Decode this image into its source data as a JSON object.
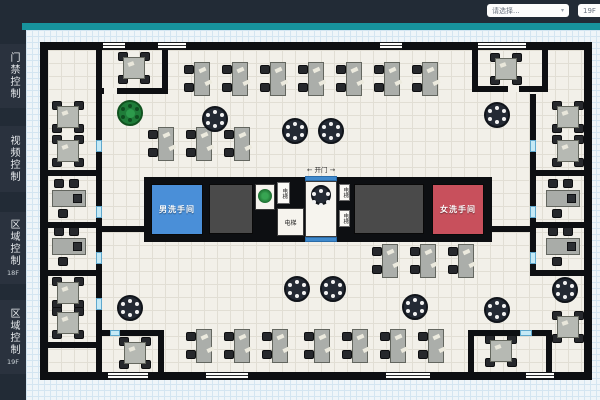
{
  "topbar": {
    "select_building": "请选择...",
    "select_floor": "19F",
    "caret": "▾"
  },
  "sidebar": {
    "items": [
      {
        "label": "门禁控制",
        "sub": ""
      },
      {
        "label": "视频控制",
        "sub": ""
      },
      {
        "label": "区域控制",
        "sub": "18F"
      },
      {
        "label": "区域控制",
        "sub": "19F"
      }
    ]
  },
  "plan": {
    "labels": {
      "men_restroom": "男洗手间",
      "women_restroom": "女洗手间",
      "elevator": "电梯",
      "door": "← 开门 →"
    },
    "colors": {
      "men": "#4a8fd8",
      "women": "#c8505c",
      "gray": "#4a4a4a",
      "wall": "#0d0f12",
      "accent": "#17939d",
      "door_bar": "#3f89cc"
    },
    "elements": [
      {
        "t": "wall",
        "x": 40,
        "y": 42,
        "w": 552,
        "h": 8,
        "name": "outer-wall-top"
      },
      {
        "t": "wall",
        "x": 40,
        "y": 372,
        "w": 552,
        "h": 8,
        "name": "outer-wall-bottom"
      },
      {
        "t": "wall",
        "x": 40,
        "y": 42,
        "w": 8,
        "h": 338,
        "name": "outer-wall-left"
      },
      {
        "t": "wall",
        "x": 584,
        "y": 42,
        "w": 8,
        "h": 338,
        "name": "outer-wall-right"
      },
      {
        "t": "winh",
        "x": 103,
        "y": 42,
        "w": 22,
        "h": 8,
        "name": "window"
      },
      {
        "t": "winh",
        "x": 158,
        "y": 42,
        "w": 28,
        "h": 8,
        "name": "window"
      },
      {
        "t": "winh",
        "x": 380,
        "y": 42,
        "w": 22,
        "h": 8,
        "name": "window"
      },
      {
        "t": "winh",
        "x": 478,
        "y": 42,
        "w": 48,
        "h": 8,
        "name": "window"
      },
      {
        "t": "winh",
        "x": 108,
        "y": 372,
        "w": 40,
        "h": 8,
        "name": "window"
      },
      {
        "t": "winh",
        "x": 206,
        "y": 372,
        "w": 42,
        "h": 8,
        "name": "window"
      },
      {
        "t": "winh",
        "x": 386,
        "y": 372,
        "w": 44,
        "h": 8,
        "name": "window"
      },
      {
        "t": "winh",
        "x": 526,
        "y": 372,
        "w": 28,
        "h": 8,
        "name": "window"
      },
      {
        "t": "wall",
        "x": 96,
        "y": 50,
        "w": 6,
        "h": 38,
        "name": "meeting-room-wall"
      },
      {
        "t": "wall",
        "x": 96,
        "y": 88,
        "w": 72,
        "h": 6,
        "name": "meeting-room-wall"
      },
      {
        "t": "whitegap",
        "x": 104,
        "y": 88,
        "w": 13,
        "h": 6,
        "name": "door-gap",
        "i": true
      },
      {
        "t": "wall",
        "x": 162,
        "y": 50,
        "w": 6,
        "h": 44,
        "name": "meeting-room-wall"
      },
      {
        "t": "wall",
        "x": 472,
        "y": 50,
        "w": 6,
        "h": 42,
        "name": "meeting-room-wall"
      },
      {
        "t": "wall",
        "x": 472,
        "y": 86,
        "w": 76,
        "h": 6,
        "name": "meeting-room-wall"
      },
      {
        "t": "whitegap",
        "x": 508,
        "y": 86,
        "w": 11,
        "h": 6,
        "name": "door-gap",
        "i": true
      },
      {
        "t": "wall",
        "x": 542,
        "y": 50,
        "w": 6,
        "h": 36,
        "name": "meeting-room-wall"
      },
      {
        "t": "wall",
        "x": 96,
        "y": 94,
        "w": 6,
        "h": 278,
        "name": "left-corridor-wall"
      },
      {
        "t": "wall",
        "x": 530,
        "y": 94,
        "w": 6,
        "h": 182,
        "name": "right-corridor-wall"
      },
      {
        "t": "wall",
        "x": 48,
        "y": 170,
        "w": 50,
        "h": 6,
        "name": "room-divider"
      },
      {
        "t": "wall",
        "x": 48,
        "y": 222,
        "w": 50,
        "h": 6,
        "name": "room-divider"
      },
      {
        "t": "wall",
        "x": 48,
        "y": 270,
        "w": 50,
        "h": 6,
        "name": "room-divider"
      },
      {
        "t": "wall",
        "x": 48,
        "y": 342,
        "w": 50,
        "h": 6,
        "name": "room-divider"
      },
      {
        "t": "wall",
        "x": 536,
        "y": 170,
        "w": 48,
        "h": 6,
        "name": "room-divider"
      },
      {
        "t": "wall",
        "x": 536,
        "y": 222,
        "w": 48,
        "h": 6,
        "name": "room-divider"
      },
      {
        "t": "wall",
        "x": 530,
        "y": 270,
        "w": 62,
        "h": 6,
        "name": "room-divider"
      },
      {
        "t": "wall",
        "x": 102,
        "y": 226,
        "w": 42,
        "h": 6,
        "name": "core-stub-wall"
      },
      {
        "t": "wall",
        "x": 492,
        "y": 226,
        "w": 38,
        "h": 6,
        "name": "core-stub-wall"
      },
      {
        "t": "wall",
        "x": 98,
        "y": 330,
        "w": 66,
        "h": 6,
        "name": "bottom-room-wall"
      },
      {
        "t": "gaph",
        "x": 110,
        "y": 330,
        "w": 10,
        "h": 6,
        "name": "door-gap",
        "i": true
      },
      {
        "t": "wall",
        "x": 158,
        "y": 330,
        "w": 6,
        "h": 42,
        "name": "bottom-room-wall"
      },
      {
        "t": "wall",
        "x": 468,
        "y": 330,
        "w": 84,
        "h": 6,
        "name": "bottom-room-wall"
      },
      {
        "t": "gaph",
        "x": 520,
        "y": 330,
        "w": 12,
        "h": 6,
        "name": "door-gap",
        "i": true
      },
      {
        "t": "wall",
        "x": 468,
        "y": 330,
        "w": 6,
        "h": 42,
        "name": "bottom-room-wall"
      },
      {
        "t": "wall",
        "x": 546,
        "y": 330,
        "w": 6,
        "h": 42,
        "name": "bottom-room-wall"
      },
      {
        "t": "gapv",
        "x": 96,
        "y": 140,
        "w": 6,
        "h": 12,
        "name": "door-gap",
        "i": true
      },
      {
        "t": "gapv",
        "x": 96,
        "y": 206,
        "w": 6,
        "h": 12,
        "name": "door-gap",
        "i": true
      },
      {
        "t": "gapv",
        "x": 96,
        "y": 252,
        "w": 6,
        "h": 12,
        "name": "door-gap",
        "i": true
      },
      {
        "t": "gapv",
        "x": 96,
        "y": 298,
        "w": 6,
        "h": 12,
        "name": "door-gap",
        "i": true
      },
      {
        "t": "gapv",
        "x": 530,
        "y": 140,
        "w": 6,
        "h": 12,
        "name": "door-gap",
        "i": true
      },
      {
        "t": "gapv",
        "x": 530,
        "y": 206,
        "w": 6,
        "h": 12,
        "name": "door-gap",
        "i": true
      },
      {
        "t": "gapv",
        "x": 530,
        "y": 252,
        "w": 6,
        "h": 12,
        "name": "door-gap",
        "i": true
      },
      {
        "t": "core",
        "x": 144,
        "y": 177,
        "w": 348,
        "h": 65,
        "name": "core-block"
      },
      {
        "t": "room",
        "c": "men",
        "x": 151,
        "y": 184,
        "w": 52,
        "h": 51,
        "label": "男洗手间",
        "name": "men-restroom",
        "i": true
      },
      {
        "t": "room",
        "c": "gray",
        "x": 209,
        "y": 184,
        "w": 44,
        "h": 50,
        "name": "stairs-block-a"
      },
      {
        "t": "cell",
        "x": 255,
        "y": 184,
        "w": 20,
        "h": 26,
        "name": "plant-cell"
      },
      {
        "t": "plant",
        "x": 258,
        "y": 189,
        "w": 14,
        "h": 14,
        "name": "plant-icon"
      },
      {
        "t": "vtag",
        "x": 277,
        "y": 182,
        "w": 13,
        "h": 22,
        "label": "电梯",
        "name": "elevator-tag",
        "i": true
      },
      {
        "t": "cell",
        "x": 277,
        "y": 208,
        "w": 27,
        "h": 28,
        "label": "电梯",
        "name": "elevator-cell",
        "i": true
      },
      {
        "t": "cell",
        "x": 305,
        "y": 181,
        "w": 32,
        "h": 56,
        "name": "lobby"
      },
      {
        "t": "bar",
        "x": 305,
        "y": 176,
        "w": 32,
        "h": 5,
        "name": "door-marker-top",
        "i": true
      },
      {
        "t": "bar",
        "x": 305,
        "y": 237,
        "w": 32,
        "h": 5,
        "name": "door-marker-bottom",
        "i": true
      },
      {
        "t": "round",
        "x": 311,
        "y": 185,
        "w": 20,
        "h": 20,
        "name": "lobby-round-table"
      },
      {
        "t": "vtag",
        "x": 339,
        "y": 184,
        "w": 11,
        "h": 17,
        "label": "电梯",
        "name": "elevator-tag",
        "i": true
      },
      {
        "t": "vtag",
        "x": 339,
        "y": 210,
        "w": 11,
        "h": 17,
        "label": "电梯",
        "name": "elevator-tag",
        "i": true
      },
      {
        "t": "room",
        "c": "gray",
        "x": 354,
        "y": 184,
        "w": 70,
        "h": 50,
        "name": "stairs-block-b"
      },
      {
        "t": "room",
        "c": "women",
        "x": 432,
        "y": 184,
        "w": 52,
        "h": 51,
        "label": "女洗手间",
        "name": "women-restroom",
        "i": true
      },
      {
        "t": "text",
        "x": 294,
        "y": 164,
        "w": 54,
        "h": 10,
        "label": "← 开门 →",
        "name": "door-label"
      },
      {
        "t": "table4",
        "x": 117,
        "y": 51,
        "name": "meeting-table"
      },
      {
        "t": "table4",
        "x": 489,
        "y": 52,
        "name": "meeting-table"
      },
      {
        "t": "table4",
        "x": 118,
        "y": 336,
        "name": "meeting-table"
      },
      {
        "t": "table4",
        "x": 484,
        "y": 334,
        "name": "meeting-table"
      },
      {
        "t": "table4",
        "x": 51,
        "y": 100,
        "name": "meeting-table"
      },
      {
        "t": "table4",
        "x": 51,
        "y": 134,
        "name": "meeting-table"
      },
      {
        "t": "table4",
        "x": 51,
        "y": 276,
        "name": "meeting-table"
      },
      {
        "t": "table4",
        "x": 51,
        "y": 306,
        "name": "meeting-table"
      },
      {
        "t": "table4",
        "x": 551,
        "y": 100,
        "name": "meeting-table"
      },
      {
        "t": "table4",
        "x": 551,
        "y": 134,
        "name": "meeting-table"
      },
      {
        "t": "table4",
        "x": 551,
        "y": 310,
        "name": "meeting-table"
      },
      {
        "t": "office",
        "x": 50,
        "y": 178,
        "name": "workstation"
      },
      {
        "t": "office",
        "x": 50,
        "y": 226,
        "name": "workstation"
      },
      {
        "t": "office",
        "x": 544,
        "y": 178,
        "name": "workstation"
      },
      {
        "t": "office",
        "x": 544,
        "y": 226,
        "name": "workstation"
      },
      {
        "t": "deskv",
        "x": 184,
        "y": 62,
        "name": "desk"
      },
      {
        "t": "deskv",
        "x": 222,
        "y": 62,
        "name": "desk"
      },
      {
        "t": "deskv",
        "x": 260,
        "y": 62,
        "name": "desk"
      },
      {
        "t": "deskv",
        "x": 298,
        "y": 62,
        "name": "desk"
      },
      {
        "t": "deskv",
        "x": 336,
        "y": 62,
        "name": "desk"
      },
      {
        "t": "deskv",
        "x": 374,
        "y": 62,
        "name": "desk"
      },
      {
        "t": "deskv",
        "x": 412,
        "y": 62,
        "name": "desk"
      },
      {
        "t": "deskv",
        "x": 148,
        "y": 127,
        "name": "desk"
      },
      {
        "t": "deskv",
        "x": 186,
        "y": 127,
        "name": "desk"
      },
      {
        "t": "deskv",
        "x": 224,
        "y": 127,
        "name": "desk"
      },
      {
        "t": "deskv",
        "x": 372,
        "y": 244,
        "name": "desk"
      },
      {
        "t": "deskv",
        "x": 410,
        "y": 244,
        "name": "desk"
      },
      {
        "t": "deskv",
        "x": 448,
        "y": 244,
        "name": "desk"
      },
      {
        "t": "deskv",
        "x": 186,
        "y": 329,
        "name": "desk"
      },
      {
        "t": "deskv",
        "x": 224,
        "y": 329,
        "name": "desk"
      },
      {
        "t": "deskv",
        "x": 262,
        "y": 329,
        "name": "desk"
      },
      {
        "t": "deskv",
        "x": 304,
        "y": 329,
        "name": "desk"
      },
      {
        "t": "deskv",
        "x": 342,
        "y": 329,
        "name": "desk"
      },
      {
        "t": "deskv",
        "x": 380,
        "y": 329,
        "name": "desk"
      },
      {
        "t": "deskv",
        "x": 418,
        "y": 329,
        "name": "desk"
      },
      {
        "t": "ground",
        "x": 117,
        "y": 100,
        "w": 26,
        "h": 26,
        "name": "green-round-table"
      },
      {
        "t": "round",
        "x": 202,
        "y": 106,
        "w": 26,
        "h": 26,
        "name": "round-table"
      },
      {
        "t": "round",
        "x": 282,
        "y": 118,
        "w": 26,
        "h": 26,
        "name": "round-table"
      },
      {
        "t": "round",
        "x": 318,
        "y": 118,
        "w": 26,
        "h": 26,
        "name": "round-table"
      },
      {
        "t": "round",
        "x": 484,
        "y": 102,
        "w": 26,
        "h": 26,
        "name": "round-table"
      },
      {
        "t": "round",
        "x": 117,
        "y": 295,
        "w": 26,
        "h": 26,
        "name": "round-table"
      },
      {
        "t": "round",
        "x": 284,
        "y": 276,
        "w": 26,
        "h": 26,
        "name": "round-table"
      },
      {
        "t": "round",
        "x": 320,
        "y": 276,
        "w": 26,
        "h": 26,
        "name": "round-table"
      },
      {
        "t": "round",
        "x": 402,
        "y": 294,
        "w": 26,
        "h": 26,
        "name": "round-table"
      },
      {
        "t": "round",
        "x": 484,
        "y": 297,
        "w": 26,
        "h": 26,
        "name": "round-table"
      },
      {
        "t": "round",
        "x": 552,
        "y": 277,
        "w": 26,
        "h": 26,
        "name": "round-table"
      }
    ]
  }
}
